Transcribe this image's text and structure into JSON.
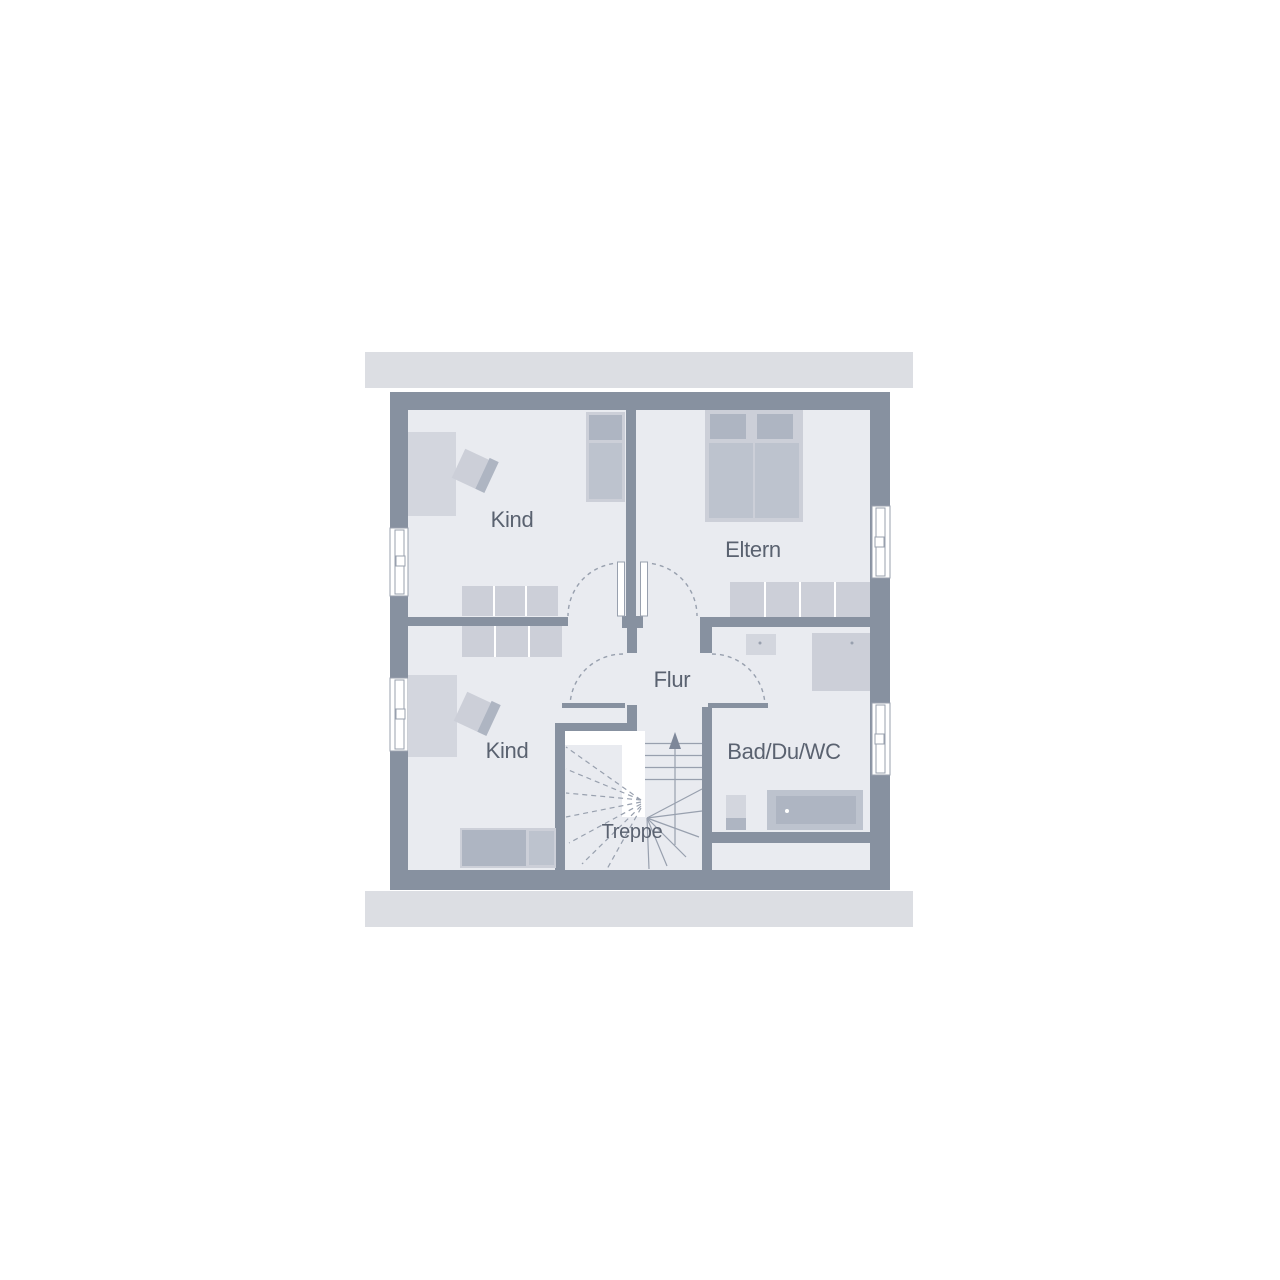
{
  "floorplan": {
    "title": "Dachgeschoss Grundriss",
    "rooms": {
      "kind_top": {
        "label": "Kind"
      },
      "eltern": {
        "label": "Eltern"
      },
      "kind_bottom": {
        "label": "Kind"
      },
      "flur": {
        "label": "Flur"
      },
      "bad": {
        "label": "Bad/Du/WC"
      },
      "treppe": {
        "label": "Treppe"
      }
    },
    "colors": {
      "wall": "#8791a0",
      "floor": "#e9ebf0",
      "slab": "#dcdee3",
      "furn_light": "#d3d6de",
      "furn_frame": "#cccfd8",
      "furn_med": "#bdc3ce",
      "furn_dark": "#aeb5c2",
      "line": "#98a0ae",
      "label": "#5a6270"
    }
  }
}
